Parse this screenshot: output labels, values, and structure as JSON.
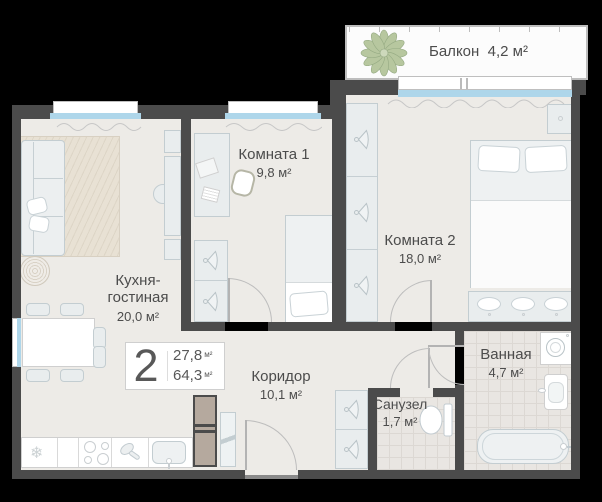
{
  "plan": {
    "badge": {
      "number": "2",
      "living_area": "27,8",
      "total_area": "64,3",
      "unit": "м²"
    },
    "rooms": {
      "balcony": {
        "label": "Балкон",
        "area": "4,2 м²"
      },
      "room1": {
        "label": "Комната 1",
        "area": "9,8 м²"
      },
      "room2": {
        "label": "Комната 2",
        "area": "18,0 м²"
      },
      "kitchen": {
        "label": "Кухня-\nгостиная",
        "area": "20,0 м²"
      },
      "corridor": {
        "label": "Коридор",
        "area": "10,1 м²"
      },
      "wc": {
        "label": "Санузел",
        "area": "1,7 м²"
      },
      "bath": {
        "label": "Ванная",
        "area": "4,7 м²"
      }
    },
    "icons": {
      "fridge_glyph": "❄"
    },
    "colors": {
      "wall": "#4b4b4b",
      "floor": "#edebe7",
      "tile_floor": "#e9e6e2",
      "window_glass": "#aed6ea",
      "furniture_fill": "#e9edee",
      "furniture_border": "#c3cdd1",
      "plant": "#b7c79f",
      "wood_cabinet": "#b5a99e",
      "background": "#000000",
      "label_text": "#4c4c4c"
    }
  }
}
